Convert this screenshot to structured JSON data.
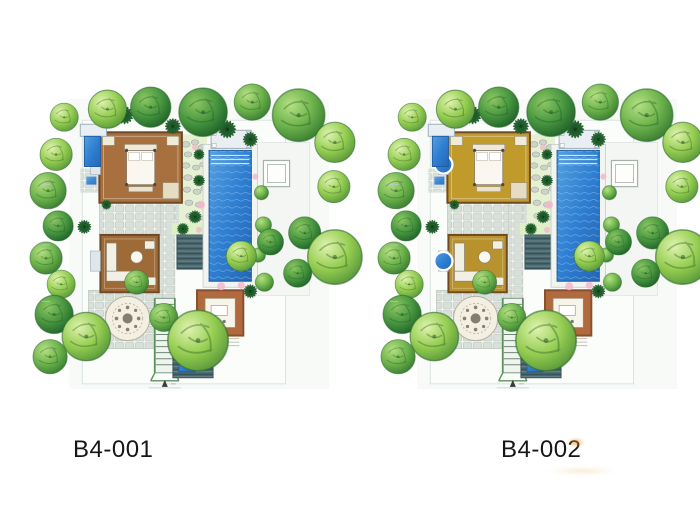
{
  "sheet": {
    "background_color": "#ffffff"
  },
  "plans": [
    {
      "label": "B4-001",
      "colors": {
        "room_primary": "#a8703f",
        "room_secondary": "#9e6b38",
        "pavilion": "#b06a3e"
      },
      "show_round_tubs": false,
      "features": [
        "swimming-pool",
        "pool-pavilion",
        "pool-terrace",
        "master-bedroom",
        "living-room",
        "stone-courtyard",
        "paving-rosette",
        "staircase",
        "entry-pavilion",
        "plunge-pool",
        "spa-deck",
        "wood-deck",
        "pebble-garden",
        "perimeter-trees",
        "palm-plants",
        "flower-accents",
        "north-arrow"
      ]
    },
    {
      "label": "B4-002",
      "colors": {
        "room_primary": "#c19a2c",
        "room_secondary": "#b8922c",
        "pavilion": "#b06a3e"
      },
      "show_round_tubs": true,
      "features": [
        "swimming-pool",
        "pool-pavilion",
        "pool-terrace",
        "bedroom-suite-1",
        "bedroom-suite-2",
        "round-bathtubs",
        "stone-courtyard",
        "paving-rosette",
        "staircase",
        "entry-pavilion",
        "plunge-pool",
        "spa-deck",
        "wood-deck",
        "pebble-garden",
        "perimeter-trees",
        "palm-plants",
        "flower-accents",
        "north-arrow"
      ]
    }
  ],
  "palette": {
    "pool_blue": "#2f7fd2",
    "pool_blue_deep": "#2565b5",
    "tree_light_green": "#94cc50",
    "tree_mid_green": "#6cb24b",
    "tree_dark_green": "#2e7d32",
    "palm_green": "#1f5c2a",
    "stone_gray": "#d9e0da",
    "deck_teal": "#47656b",
    "flower_pink": "#f3b9cd",
    "label_text": "#161616",
    "smudge_orange": "#e79428"
  }
}
